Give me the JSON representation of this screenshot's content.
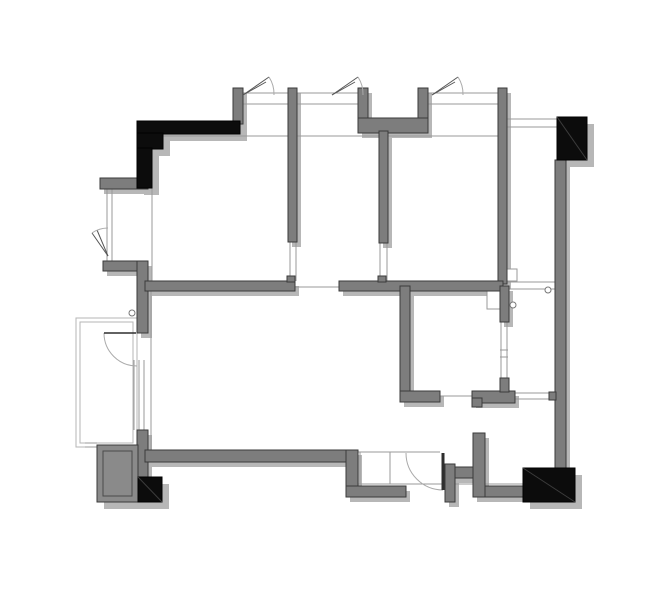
{
  "meta": {
    "kind": "architectural-floor-plan",
    "width": 670,
    "height": 603
  },
  "palette": {
    "background": "#ffffff",
    "wall_fill": "#7d7d7d",
    "wall_stroke": "#3a3a3a",
    "black_fill": "#0c0c0c",
    "black_diag": "#3c3c3c",
    "shadow": "#b7b7b7",
    "thin_line": "#9a9a9a",
    "light_line": "#b5b5b5",
    "door_leaf": "#2e2e2e",
    "arc_line": "#aaaaaa",
    "shaft_fill": "#8a8a8a"
  },
  "shadow_offset": {
    "dx": 4,
    "dy": 5
  },
  "block_shadow_offset": {
    "dx": 7,
    "dy": 7
  },
  "walls_gray": [
    {
      "name": "wall-pier-top-1",
      "x": 233,
      "y": 88,
      "w": 10,
      "h": 36
    },
    {
      "name": "wall-partition-top-1",
      "x": 288,
      "y": 88,
      "w": 9,
      "h": 154
    },
    {
      "name": "wall-duct-left",
      "x": 358,
      "y": 88,
      "w": 10,
      "h": 45
    },
    {
      "name": "wall-duct-right",
      "x": 418,
      "y": 88,
      "w": 10,
      "h": 45
    },
    {
      "name": "wall-duct-bottom",
      "x": 358,
      "y": 118,
      "w": 70,
      "h": 15
    },
    {
      "name": "wall-partition-top-2",
      "x": 379,
      "y": 131,
      "w": 9,
      "h": 112
    },
    {
      "name": "wall-pier-top-right",
      "x": 498,
      "y": 88,
      "w": 9,
      "h": 196
    },
    {
      "name": "wall-left-upper",
      "x": 100,
      "y": 178,
      "w": 48,
      "h": 11
    },
    {
      "name": "wall-left-mid-h",
      "x": 103,
      "y": 261,
      "w": 45,
      "h": 10
    },
    {
      "name": "wall-left-mid-v",
      "x": 137,
      "y": 261,
      "w": 11,
      "h": 72
    },
    {
      "name": "wall-left-lower-v",
      "x": 137,
      "y": 430,
      "w": 11,
      "h": 47
    },
    {
      "name": "wall-bottom-main",
      "x": 145,
      "y": 450,
      "w": 213,
      "h": 12
    },
    {
      "name": "wall-bottom-step",
      "x": 346,
      "y": 450,
      "w": 12,
      "h": 47
    },
    {
      "name": "wall-bottom-lower",
      "x": 346,
      "y": 486,
      "w": 60,
      "h": 11
    },
    {
      "name": "wall-entry-stub",
      "x": 445,
      "y": 464,
      "w": 10,
      "h": 38
    },
    {
      "name": "wall-entry-link",
      "x": 455,
      "y": 467,
      "w": 18,
      "h": 11
    },
    {
      "name": "wall-entry-tall",
      "x": 473,
      "y": 433,
      "w": 12,
      "h": 64
    },
    {
      "name": "wall-bottom-right",
      "x": 485,
      "y": 486,
      "w": 38,
      "h": 11
    },
    {
      "name": "wall-right-main",
      "x": 555,
      "y": 160,
      "w": 11,
      "h": 308
    },
    {
      "name": "wall-right-nub",
      "x": 549,
      "y": 392,
      "w": 7,
      "h": 8,
      "ns": true
    },
    {
      "name": "wall-middle-left",
      "x": 145,
      "y": 281,
      "w": 150,
      "h": 10
    },
    {
      "name": "wall-middle-left-nub",
      "x": 287,
      "y": 276,
      "w": 8,
      "h": 6,
      "ns": true
    },
    {
      "name": "wall-middle-right",
      "x": 339,
      "y": 281,
      "w": 164,
      "h": 10
    },
    {
      "name": "wall-middle-right-nub",
      "x": 378,
      "y": 276,
      "w": 8,
      "h": 6,
      "ns": true
    },
    {
      "name": "wall-bath-left-v",
      "x": 400,
      "y": 286,
      "w": 10,
      "h": 110
    },
    {
      "name": "wall-bath-bottom-left",
      "x": 400,
      "y": 391,
      "w": 40,
      "h": 11
    },
    {
      "name": "wall-bath-bottom-right",
      "x": 472,
      "y": 391,
      "w": 43,
      "h": 12
    },
    {
      "name": "wall-bath-notch",
      "x": 472,
      "y": 398,
      "w": 10,
      "h": 9,
      "ns": true
    },
    {
      "name": "wall-bath-nub",
      "x": 500,
      "y": 385,
      "w": 8,
      "h": 7,
      "ns": true
    },
    {
      "name": "wall-bath-divider-top",
      "x": 500,
      "y": 286,
      "w": 9,
      "h": 36
    },
    {
      "name": "wall-bath-divider-bot",
      "x": 500,
      "y": 378,
      "w": 9,
      "h": 14,
      "ns": true
    }
  ],
  "walls_black": [
    {
      "name": "column-nw-bar",
      "x": 137,
      "y": 121,
      "w": 103,
      "h": 13,
      "diag": false
    },
    {
      "name": "column-nw-step",
      "x": 137,
      "y": 133,
      "w": 26,
      "h": 16,
      "diag": false
    },
    {
      "name": "column-nw-leg",
      "x": 137,
      "y": 148,
      "w": 15,
      "h": 40,
      "diag": false
    },
    {
      "name": "column-ne",
      "x": 557,
      "y": 117,
      "w": 30,
      "h": 43,
      "diag": true
    },
    {
      "name": "column-se",
      "x": 523,
      "y": 468,
      "w": 52,
      "h": 34,
      "diag": true
    },
    {
      "name": "column-sw",
      "x": 138,
      "y": 477,
      "w": 24,
      "h": 25,
      "diag": true
    }
  ],
  "shaft_block": {
    "name": "shaft-sw",
    "x": 97,
    "y": 445,
    "w": 41,
    "h": 57,
    "inset": 6
  },
  "balcony": {
    "name": "balcony-rail",
    "outer": {
      "x": 76,
      "y": 318,
      "w": 61,
      "h": 129
    },
    "inner": {
      "x": 80,
      "y": 322,
      "w": 53,
      "h": 121
    }
  },
  "thin_segments": [
    [
      242,
      93,
      288,
      93
    ],
    [
      242,
      104,
      288,
      104
    ],
    [
      297,
      93,
      358,
      93
    ],
    [
      297,
      104,
      358,
      104
    ],
    [
      428,
      93,
      498,
      93
    ],
    [
      428,
      104,
      498,
      104
    ],
    [
      152,
      136,
      498,
      136
    ],
    [
      507,
      119,
      557,
      119
    ],
    [
      507,
      127,
      557,
      127
    ],
    [
      107,
      189,
      107,
      261
    ],
    [
      112,
      189,
      112,
      261
    ],
    [
      152,
      136,
      152,
      281
    ],
    [
      151,
      291,
      151,
      450
    ],
    [
      134,
      360,
      134,
      430
    ],
    [
      139,
      360,
      139,
      430
    ],
    [
      144,
      360,
      144,
      430
    ],
    [
      290,
      242,
      290,
      281
    ],
    [
      296,
      242,
      296,
      281
    ],
    [
      380,
      243,
      380,
      281
    ],
    [
      387,
      243,
      387,
      281
    ],
    [
      295,
      287,
      339,
      287
    ],
    [
      507,
      282,
      555,
      282
    ],
    [
      507,
      289,
      555,
      289
    ],
    [
      515,
      393,
      553,
      393
    ],
    [
      515,
      399,
      553,
      399
    ],
    [
      440,
      396,
      472,
      396
    ],
    [
      501,
      322,
      501,
      380
    ],
    [
      507,
      322,
      507,
      380
    ],
    [
      500,
      350,
      508,
      350
    ],
    [
      500,
      357,
      508,
      357
    ],
    [
      358,
      484,
      523,
      484
    ],
    [
      358,
      452,
      440,
      452
    ],
    [
      360,
      452,
      360,
      484
    ],
    [
      390,
      452,
      390,
      484
    ],
    [
      85,
      443,
      97,
      443
    ],
    [
      85,
      447,
      97,
      447
    ]
  ],
  "thin_rects": [
    {
      "name": "threshold-top-right-room",
      "x": 505,
      "y": 269,
      "w": 12,
      "h": 12
    },
    {
      "name": "fixture-shower-corner",
      "x": 487,
      "y": 289,
      "w": 13,
      "h": 20
    }
  ],
  "circles": [
    {
      "name": "door-pivot-mark-left",
      "cx": 132,
      "cy": 313,
      "r": 3
    },
    {
      "name": "door-pivot-mark-bath",
      "cx": 513,
      "cy": 305,
      "r": 3
    },
    {
      "name": "door-pivot-mark-right",
      "cx": 548,
      "cy": 290,
      "r": 3
    }
  ],
  "doors": [
    {
      "name": "door-balcony",
      "leaf": [
        104,
        333,
        136,
        333
      ],
      "leaf_w": 1.6,
      "arc": "M 104 333 A 33 33 0 0 0 137 366"
    },
    {
      "name": "door-entry",
      "leaf": [
        443,
        453,
        443,
        490
      ],
      "leaf_w": 3,
      "arc": "M 406 453 A 37 37 0 0 0 443 490"
    }
  ],
  "casement_symbols": [
    {
      "name": "window-casement-1",
      "lines": [
        [
          243,
          95,
          269,
          77
        ],
        [
          243,
          95,
          266,
          82
        ]
      ],
      "arc": "M 269 77 A 31 31 0 0 1 274 95"
    },
    {
      "name": "window-casement-2",
      "lines": [
        [
          332,
          95,
          358,
          77
        ],
        [
          332,
          95,
          355,
          82
        ]
      ],
      "arc": "M 358 77 A 31 31 0 0 1 363 95"
    },
    {
      "name": "window-casement-3",
      "lines": [
        [
          432,
          95,
          458,
          77
        ],
        [
          432,
          95,
          455,
          82
        ]
      ],
      "arc": "M 458 77 A 31 31 0 0 1 463 95"
    },
    {
      "name": "window-casement-left",
      "lines": [
        [
          108,
          256,
          92,
          233
        ],
        [
          108,
          256,
          97,
          230
        ]
      ],
      "arc": "M 92 233 A 28 28 0 0 1 108 228"
    }
  ]
}
